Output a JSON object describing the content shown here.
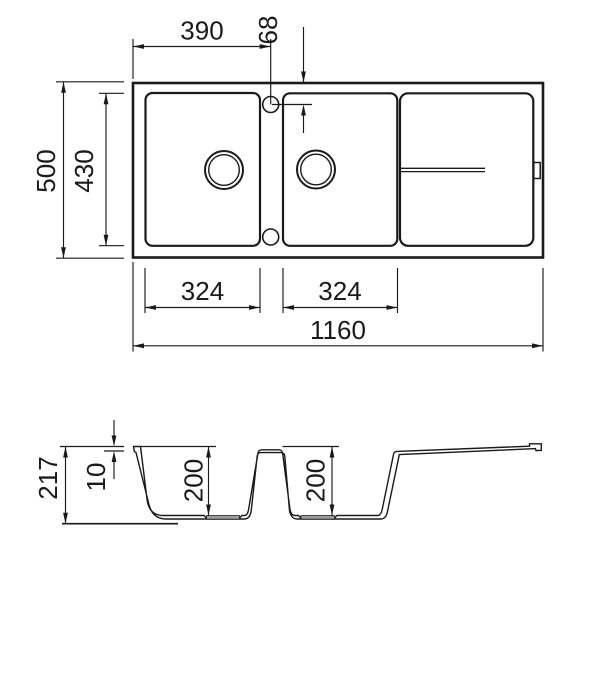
{
  "drawing": {
    "type": "kitchen-sink technical dimension drawing, top view and cross-section",
    "ink": "#1a1a1a",
    "recess_gray": "#9c9c9c",
    "background": "#ffffff",
    "dimensions": {
      "top": {
        "tap_hole_from_left": "390",
        "tap_hole_from_front": "68",
        "overall_depth": "500",
        "inner_depth": "430",
        "left_bowl_width": "324",
        "right_bowl_width": "324",
        "overall_width": "1160"
      },
      "section": {
        "overall_height": "217",
        "rim_height": "10",
        "left_bowl_depth": "200",
        "right_bowl_depth": "200"
      }
    }
  }
}
